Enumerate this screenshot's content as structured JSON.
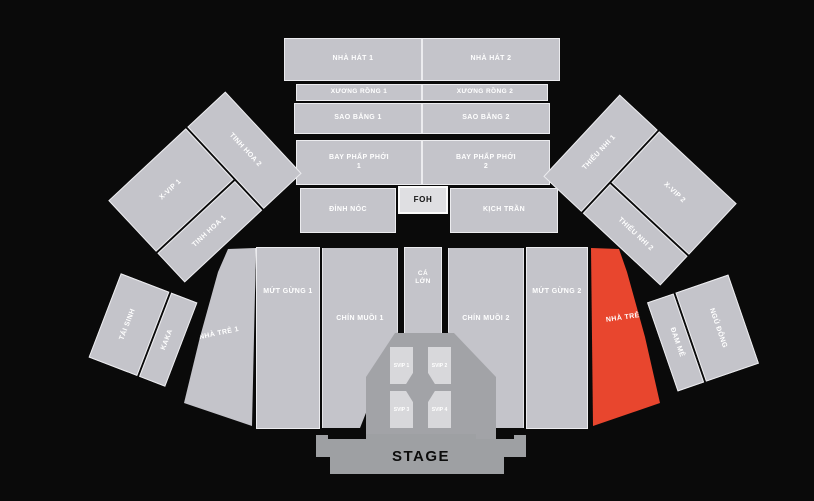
{
  "map_title": "Concert seating map",
  "colors": {
    "background": "#0a0a0a",
    "section_gray": "#c4c4ca",
    "highlight_red": "#e8462e",
    "stage_gray": "#9ea0a3",
    "label_text": "#ffffff"
  },
  "stage": {
    "label": "STAGE"
  },
  "foh": {
    "label": "FOH"
  },
  "sections": {
    "nha_hat_1": {
      "label": "NHÀ HÁT 1"
    },
    "nha_hat_2": {
      "label": "NHÀ HÁT 2"
    },
    "xuong_rong_1": {
      "label": "XƯƠNG RỒNG 1"
    },
    "xuong_rong_2": {
      "label": "XƯƠNG RỒNG 2"
    },
    "sao_bang_1": {
      "label": "SAO BĂNG 1"
    },
    "sao_bang_2": {
      "label": "SAO BĂNG 2"
    },
    "bay_phap_phoi_1": {
      "label": "BAY PHẤP PHỚI 1"
    },
    "bay_phap_phoi_2": {
      "label": "BAY PHẤP PHỚI 2"
    },
    "dinh_noc": {
      "label": "ĐỈNH NÓC"
    },
    "kich_tran": {
      "label": "KỊCH TRẦN"
    },
    "x_vip_1": {
      "label": "X-VIP 1"
    },
    "tinh_hoa_1": {
      "label": "TINH HOA 1"
    },
    "tinh_hoa_2": {
      "label": "TINH HOA 2"
    },
    "x_vip_2": {
      "label": "X-VIP 2"
    },
    "thieu_nhi_1": {
      "label": "THIẾU NHI 1"
    },
    "thieu_nhi_2": {
      "label": "THIẾU NHI 2"
    },
    "nha_tre_1": {
      "label": "NHÀ TRẺ 1"
    },
    "mut_gung_1": {
      "label": "MỨT GỪNG 1"
    },
    "chin_muoi_1": {
      "label": "CHÍN MUỒI 1"
    },
    "ca_lon": {
      "label": "CÁ LỚN"
    },
    "chin_muoi_2": {
      "label": "CHÍN MUỒI 2"
    },
    "mut_gung_2": {
      "label": "MỨT GỪNG 2"
    },
    "nha_tre_2": {
      "label": "NHÀ TRẺ 2",
      "status": "highlighted"
    },
    "tai_sinh": {
      "label": "TÁI SINH"
    },
    "kaka": {
      "label": "KAKA"
    },
    "dam_me": {
      "label": "ĐAM MÊ"
    },
    "ngu_dong": {
      "label": "NGỦ ĐÔNG"
    },
    "svip_1": {
      "label": "SVIP 1"
    },
    "svip_2": {
      "label": "SVIP 2"
    },
    "svip_3": {
      "label": "SVIP 3"
    },
    "svip_4": {
      "label": "SVIP 4"
    }
  }
}
